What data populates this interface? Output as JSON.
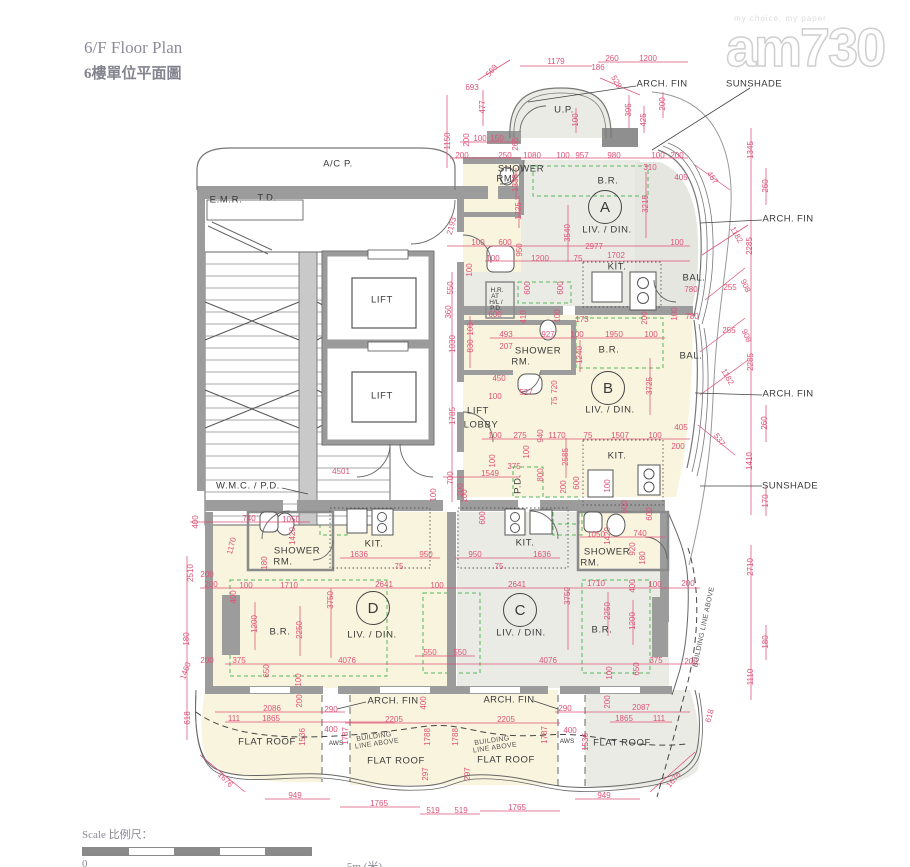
{
  "meta": {
    "title_en": "6/F Floor Plan",
    "title_zh": "6樓單位平面圖"
  },
  "watermark": {
    "tagline": "my choice, my paper",
    "brand": "am730"
  },
  "scalebar": {
    "label": "Scale 比例尺：",
    "start": "0",
    "end": "5m (米)"
  },
  "colors": {
    "dimension_red": "#DE5377",
    "wall_gray": "#9C9C9C",
    "unit_cream": "#F9F4DD",
    "unit_gray": "#EBEBE6",
    "green_dash": "#55B85A"
  },
  "units": [
    {
      "letter": "A",
      "x": 605,
      "y": 207
    },
    {
      "letter": "B",
      "x": 608,
      "y": 388
    },
    {
      "letter": "C",
      "x": 520,
      "y": 610
    },
    {
      "letter": "D",
      "x": 373,
      "y": 608
    }
  ],
  "labels": [
    [
      "693",
      472,
      88
    ],
    [
      "569",
      492,
      71,
      -50
    ],
    [
      "1179",
      556,
      62
    ],
    [
      "186",
      598,
      68
    ],
    [
      "260",
      612,
      59
    ],
    [
      "1200",
      648,
      59
    ],
    [
      "529",
      616,
      82,
      60
    ],
    [
      "477",
      483,
      107,
      -90
    ],
    [
      "100",
      576,
      120,
      -90
    ],
    [
      "395",
      629,
      110,
      -90
    ],
    [
      "200",
      663,
      104,
      -90
    ],
    [
      "425",
      644,
      120,
      -90
    ],
    [
      "1150",
      448,
      141,
      -90
    ],
    [
      "200",
      467,
      140,
      -90
    ],
    [
      "100",
      480,
      139
    ],
    [
      "150",
      497,
      139
    ],
    [
      "265",
      516,
      144,
      -90
    ],
    [
      "200",
      462,
      156
    ],
    [
      "250",
      505,
      156
    ],
    [
      "1080",
      532,
      156
    ],
    [
      "100",
      563,
      156
    ],
    [
      "957",
      582,
      156
    ],
    [
      "980",
      614,
      156
    ],
    [
      "100",
      658,
      156
    ],
    [
      "200",
      677,
      156
    ],
    [
      "310",
      650,
      168
    ],
    [
      "405",
      681,
      178
    ],
    [
      "457",
      712,
      178,
      55
    ],
    [
      "1345",
      751,
      150,
      -90
    ],
    [
      "260",
      766,
      186,
      -90
    ],
    [
      "1335",
      516,
      183,
      -90
    ],
    [
      "1725",
      519,
      211,
      -90
    ],
    [
      "2193",
      452,
      226,
      -75
    ],
    [
      "3540",
      568,
      233,
      -90
    ],
    [
      "3215",
      646,
      204,
      -90
    ],
    [
      "2977",
      594,
      247
    ],
    [
      "100",
      478,
      243
    ],
    [
      "600",
      505,
      243
    ],
    [
      "100",
      677,
      243
    ],
    [
      "100",
      493,
      259
    ],
    [
      "1200",
      540,
      259
    ],
    [
      "75",
      578,
      259
    ],
    [
      "1702",
      616,
      256
    ],
    [
      "950",
      520,
      250,
      -90
    ],
    [
      "100",
      470,
      270,
      -90
    ],
    [
      "780",
      691,
      290
    ],
    [
      "255",
      730,
      288
    ],
    [
      "908",
      745,
      286,
      65
    ],
    [
      "2285",
      750,
      246,
      -90
    ],
    [
      "1182",
      736,
      235,
      60
    ],
    [
      "100",
      675,
      314,
      -90
    ],
    [
      "780",
      692,
      317
    ],
    [
      "255",
      729,
      331
    ],
    [
      "908",
      746,
      336,
      65
    ],
    [
      "2285",
      751,
      362,
      -90
    ],
    [
      "1182",
      727,
      377,
      60
    ],
    [
      "260",
      765,
      423,
      -90
    ],
    [
      "537",
      719,
      440,
      55
    ],
    [
      "1410",
      750,
      461,
      -90
    ],
    [
      "170",
      766,
      501,
      -90
    ],
    [
      "550",
      451,
      288,
      -90
    ],
    [
      "360",
      449,
      312,
      -90
    ],
    [
      "1030",
      453,
      344,
      -90
    ],
    [
      "830",
      471,
      346,
      -90
    ],
    [
      "100",
      471,
      329,
      -90
    ],
    [
      "600",
      495,
      315
    ],
    [
      "600",
      528,
      288,
      -90
    ],
    [
      "600",
      561,
      288,
      -90
    ],
    [
      "410",
      524,
      317,
      -90
    ],
    [
      "100",
      558,
      316,
      -90
    ],
    [
      "173",
      582,
      320
    ],
    [
      "200",
      645,
      318,
      -90
    ],
    [
      "493",
      506,
      335
    ],
    [
      "927",
      548,
      335
    ],
    [
      "207",
      506,
      347
    ],
    [
      "100",
      577,
      335
    ],
    [
      "1950",
      614,
      335
    ],
    [
      "100",
      651,
      335
    ],
    [
      "1240",
      580,
      355,
      -90
    ],
    [
      "450",
      499,
      379
    ],
    [
      "527",
      526,
      393
    ],
    [
      "100",
      495,
      397
    ],
    [
      "720",
      555,
      387,
      -90
    ],
    [
      "75",
      555,
      401,
      -90
    ],
    [
      "3725",
      650,
      386,
      -90
    ],
    [
      "1785",
      453,
      416,
      -90
    ],
    [
      "700",
      451,
      478,
      -90
    ],
    [
      "4501",
      341,
      472
    ],
    [
      "100",
      495,
      436
    ],
    [
      "275",
      520,
      436
    ],
    [
      "940",
      541,
      436,
      -90
    ],
    [
      "1170",
      557,
      436
    ],
    [
      "75",
      588,
      436
    ],
    [
      "1507",
      620,
      436
    ],
    [
      "100",
      655,
      436
    ],
    [
      "405",
      681,
      428
    ],
    [
      "200",
      678,
      447
    ],
    [
      "100",
      527,
      452,
      -90
    ],
    [
      "2585",
      566,
      457,
      -90
    ],
    [
      "100",
      493,
      461,
      -90
    ],
    [
      "1549",
      490,
      474
    ],
    [
      "375",
      514,
      467
    ],
    [
      "800",
      541,
      475,
      -90
    ],
    [
      "200",
      564,
      487,
      -90
    ],
    [
      "600",
      577,
      483,
      -90
    ],
    [
      "100",
      608,
      486,
      -90
    ],
    [
      "600",
      625,
      507,
      -90
    ],
    [
      "100",
      465,
      496,
      -90
    ],
    [
      "600",
      483,
      518,
      -90
    ],
    [
      "100",
      434,
      495,
      -90
    ],
    [
      "200",
      461,
      490,
      -90
    ],
    [
      "740",
      249,
      519
    ],
    [
      "1050",
      291,
      520
    ],
    [
      "400",
      196,
      522,
      -90
    ],
    [
      "1170",
      232,
      546,
      -75
    ],
    [
      "1420",
      293,
      536,
      -90
    ],
    [
      "180",
      265,
      563,
      -90
    ],
    [
      "1636",
      359,
      555
    ],
    [
      "75",
      399,
      567
    ],
    [
      "950",
      426,
      555
    ],
    [
      "600",
      650,
      514,
      -90
    ],
    [
      "200",
      211,
      585
    ],
    [
      "100",
      246,
      586
    ],
    [
      "400",
      234,
      597,
      -90
    ],
    [
      "1710",
      289,
      586
    ],
    [
      "2641",
      384,
      585
    ],
    [
      "100",
      437,
      586
    ],
    [
      "3750",
      331,
      600,
      -90
    ],
    [
      "1200",
      255,
      624,
      -90
    ],
    [
      "2250",
      300,
      630,
      -90
    ],
    [
      "375",
      239,
      661
    ],
    [
      "4076",
      347,
      661
    ],
    [
      "650",
      267,
      671,
      -90
    ],
    [
      "100",
      299,
      680,
      -90
    ],
    [
      "550",
      430,
      653
    ],
    [
      "550",
      460,
      653
    ],
    [
      "1050",
      596,
      535
    ],
    [
      "1420",
      608,
      536,
      -90
    ],
    [
      "740",
      640,
      534
    ],
    [
      "920",
      633,
      549,
      -90
    ],
    [
      "180",
      643,
      558,
      -90
    ],
    [
      "1636",
      542,
      555
    ],
    [
      "75",
      499,
      567
    ],
    [
      "950",
      475,
      555
    ],
    [
      "1710",
      596,
      584
    ],
    [
      "400",
      633,
      586,
      -90
    ],
    [
      "100",
      655,
      585
    ],
    [
      "200",
      688,
      584
    ],
    [
      "2641",
      517,
      585
    ],
    [
      "3750",
      568,
      596,
      -90
    ],
    [
      "2250",
      608,
      611,
      -90
    ],
    [
      "1200",
      633,
      621,
      -90
    ],
    [
      "375",
      656,
      661
    ],
    [
      "200",
      691,
      662
    ],
    [
      "4076",
      548,
      661
    ],
    [
      "650",
      637,
      669,
      -90
    ],
    [
      "100",
      610,
      673,
      -90
    ],
    [
      "2510",
      191,
      573,
      -90
    ],
    [
      "180",
      187,
      639,
      -90
    ],
    [
      "1460",
      186,
      671,
      -70
    ],
    [
      "618",
      188,
      718,
      -90
    ],
    [
      "200",
      207,
      575
    ],
    [
      "200",
      207,
      661
    ],
    [
      "1676",
      225,
      780,
      45
    ],
    [
      "2710",
      751,
      567,
      -90
    ],
    [
      "180",
      766,
      642,
      -90
    ],
    [
      "1110",
      751,
      677,
      -90
    ],
    [
      "618",
      710,
      716,
      -75
    ],
    [
      "1676",
      674,
      780,
      -50
    ],
    [
      "200",
      300,
      701,
      -90
    ],
    [
      "2086",
      272,
      709
    ],
    [
      "290",
      331,
      710
    ],
    [
      "111",
      234,
      719
    ],
    [
      "1865",
      271,
      719
    ],
    [
      "400",
      424,
      703,
      -90
    ],
    [
      "2205",
      394,
      720
    ],
    [
      "2205",
      506,
      720
    ],
    [
      "1536",
      303,
      737,
      -90
    ],
    [
      "400",
      331,
      730
    ],
    [
      "1787",
      346,
      736,
      -90
    ],
    [
      "1788",
      428,
      737,
      -90
    ],
    [
      "1788",
      456,
      737,
      -90
    ],
    [
      "1787",
      545,
      735,
      -90
    ],
    [
      "297",
      426,
      774,
      -90
    ],
    [
      "297",
      468,
      774,
      -90
    ],
    [
      "949",
      295,
      796
    ],
    [
      "1765",
      379,
      804
    ],
    [
      "519",
      433,
      811
    ],
    [
      "519",
      461,
      811
    ],
    [
      "1765",
      517,
      808
    ],
    [
      "290",
      565,
      709
    ],
    [
      "2087",
      641,
      708
    ],
    [
      "200",
      608,
      702,
      -90
    ],
    [
      "1865",
      624,
      719
    ],
    [
      "111",
      659,
      719
    ],
    [
      "400",
      570,
      731
    ],
    [
      "1536",
      586,
      742,
      -90
    ],
    [
      "949",
      604,
      796
    ],
    [
      "U.P.",
      564,
      110,
      0,
      "r"
    ],
    [
      "A/C P.",
      338,
      164,
      0,
      "r"
    ],
    [
      "E.M.R.",
      226,
      200,
      0,
      "r"
    ],
    [
      "T.D.",
      267,
      198,
      0,
      "r"
    ],
    [
      "LIFT",
      382,
      300,
      0,
      "r"
    ],
    [
      "LIFT",
      382,
      396,
      0,
      "r"
    ],
    [
      "LIFT",
      478,
      411,
      0,
      "r"
    ],
    [
      "LOBBY",
      481,
      425,
      0,
      "r"
    ],
    [
      "W.M.C. / P.D.",
      248,
      486,
      0,
      "r"
    ],
    [
      "P.D.",
      518,
      484,
      -90,
      "r"
    ],
    [
      "SHOWER",
      521,
      169,
      0,
      "r"
    ],
    [
      "RM.",
      506,
      179,
      0,
      "r"
    ],
    [
      "B.R.",
      608,
      181,
      0,
      "r"
    ],
    [
      "LIV. / DIN.",
      607,
      230,
      0,
      "r"
    ],
    [
      "KIT.",
      617,
      267,
      0,
      "r"
    ],
    [
      "BAL.",
      694,
      278,
      0,
      "r"
    ],
    [
      "SHOWER",
      538,
      351,
      0,
      "r"
    ],
    [
      "RM.",
      521,
      362,
      0,
      "r"
    ],
    [
      "B.R.",
      609,
      350,
      0,
      "r"
    ],
    [
      "BAL.",
      691,
      356,
      0,
      "r"
    ],
    [
      "LIV. / DIN.",
      610,
      410,
      0,
      "r"
    ],
    [
      "KIT.",
      617,
      456,
      0,
      "r"
    ],
    [
      "SHOWER",
      297,
      551,
      0,
      "r"
    ],
    [
      "RM.",
      283,
      562,
      0,
      "r"
    ],
    [
      "KIT.",
      374,
      544,
      0,
      "r"
    ],
    [
      "KIT.",
      525,
      543,
      0,
      "r"
    ],
    [
      "SHOWER",
      607,
      552,
      0,
      "r"
    ],
    [
      "RM.",
      590,
      563,
      0,
      "r"
    ],
    [
      "B.R.",
      280,
      632,
      0,
      "r"
    ],
    [
      "LIV. / DIN.",
      372,
      635,
      0,
      "r"
    ],
    [
      "LIV. / DIN.",
      521,
      633,
      0,
      "r"
    ],
    [
      "B.R.",
      602,
      630,
      0,
      "r"
    ],
    [
      "FLAT ROOF",
      267,
      742,
      0,
      "r"
    ],
    [
      "FLAT ROOF",
      396,
      761,
      0,
      "r"
    ],
    [
      "FLAT ROOF",
      506,
      760,
      0,
      "r"
    ],
    [
      "FLAT ROOF",
      622,
      743,
      0,
      "r"
    ],
    [
      "H.R.",
      497,
      291,
      0,
      "s"
    ],
    [
      "AT",
      495,
      297,
      0,
      "s"
    ],
    [
      "H/L /",
      496,
      303,
      0,
      "s"
    ],
    [
      "P.D.",
      496,
      309,
      0,
      "s"
    ],
    [
      "AWS",
      336,
      744,
      0,
      "s"
    ],
    [
      "AWS",
      567,
      742,
      0,
      "s"
    ],
    [
      "ARCH. FIN",
      662,
      84,
      0,
      "a"
    ],
    [
      "SUNSHADE",
      754,
      84,
      0,
      "a"
    ],
    [
      "ARCH. FIN",
      788,
      219,
      0,
      "a"
    ],
    [
      "ARCH. FIN",
      788,
      394,
      0,
      "a"
    ],
    [
      "SUNSHADE",
      790,
      486,
      0,
      "a"
    ],
    [
      "ARCH. FIN",
      393,
      701,
      0,
      "a"
    ],
    [
      "ARCH. FIN",
      509,
      700,
      0,
      "a"
    ],
    [
      "BUILDING",
      374,
      737,
      -8,
      "a2"
    ],
    [
      "LINE ABOVE",
      377,
      744,
      -8,
      "a2"
    ],
    [
      "BUILDING",
      492,
      741,
      -8,
      "a2"
    ],
    [
      "LINE ABOVE",
      495,
      748,
      -8,
      "a2"
    ],
    [
      "BUILDING LINE ABOVE",
      704,
      627,
      -78,
      "a2"
    ]
  ]
}
